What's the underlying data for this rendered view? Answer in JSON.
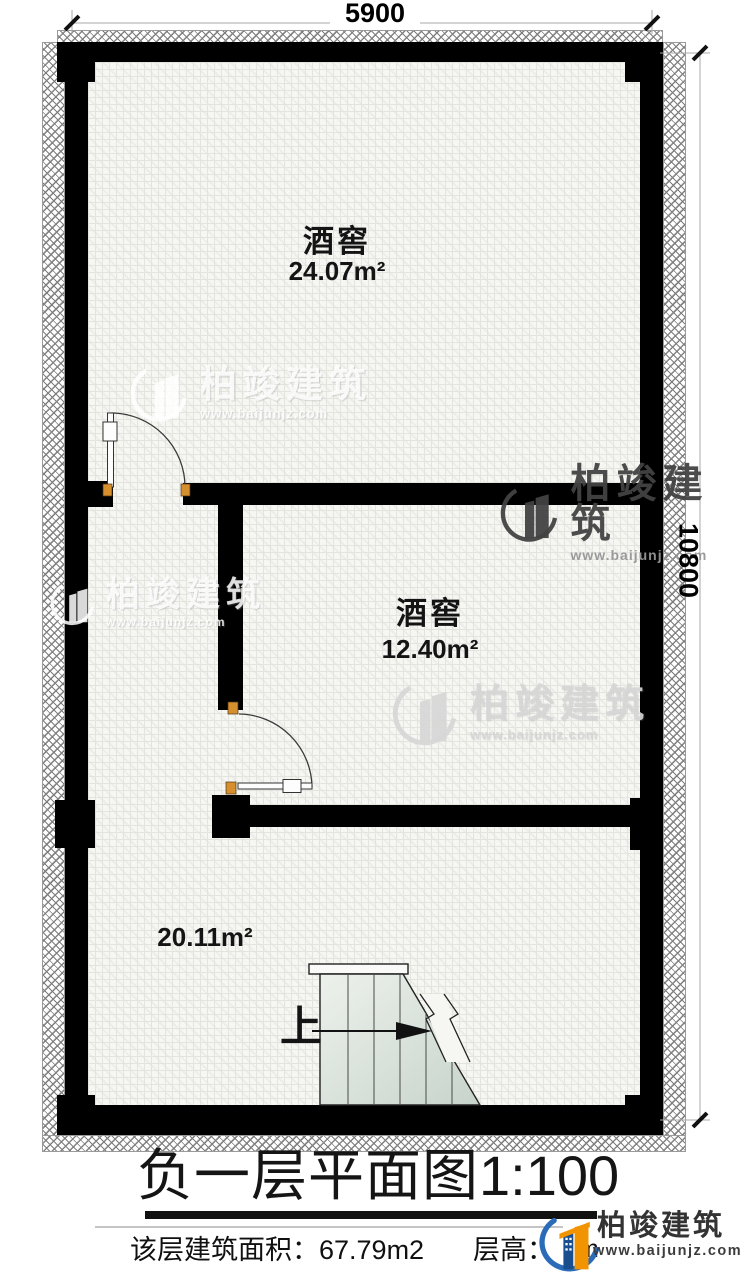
{
  "dims": {
    "top": "5900",
    "right": "10800"
  },
  "rooms": [
    {
      "name": "酒窖",
      "area": "24.07m²"
    },
    {
      "name": "酒窖",
      "area": "12.40m²"
    },
    {
      "name": "",
      "area": "20.11m²"
    }
  ],
  "stairs": {
    "up_label": "上"
  },
  "title": {
    "main": "负一层平面图",
    "scale": "1:100"
  },
  "footer": {
    "area_label": "该层建筑面积：",
    "area_value": "67.79m2",
    "height_label": "层高：",
    "height_visible": "m"
  },
  "brand": {
    "name": "柏竣建筑",
    "url": "www.baijunjz.com"
  },
  "colors": {
    "accent_orange": "#f29400",
    "accent_blue": "#2b6cb8",
    "wall": "#000000",
    "hinge": "#d78f2e"
  }
}
